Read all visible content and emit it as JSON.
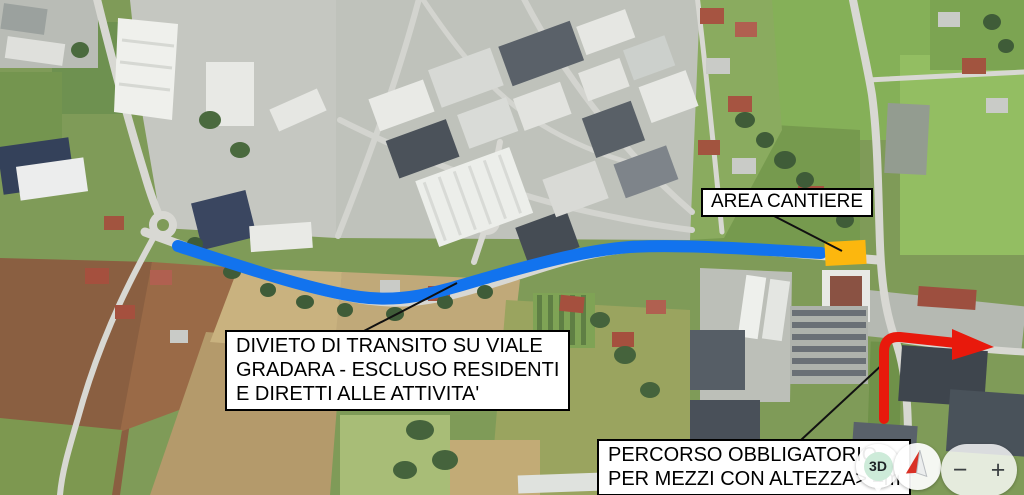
{
  "annotations": {
    "area_cantiere": {
      "label": "AREA CANTIERE"
    },
    "divieto": {
      "lines": [
        "DIVIETO DI TRANSITO SU VIALE",
        "GRADARA - ESCLUSO RESIDENTI",
        "E DIRETTI ALLE ATTIVITA'"
      ]
    },
    "percorso": {
      "lines": [
        "PERCORSO OBBLIGATORIO",
        "PER MEZZI CON ALTEZZA> 4m"
      ]
    },
    "colors": {
      "route_blue": "#1273ee",
      "construction_orange": "#fcb70e",
      "mandatory_route_red": "#e8190c",
      "leader_line": "#111111"
    }
  },
  "controls": {
    "view_3d": "3D",
    "compass_icon": "compass-needle",
    "zoom_out": "−",
    "zoom_in": "+"
  }
}
